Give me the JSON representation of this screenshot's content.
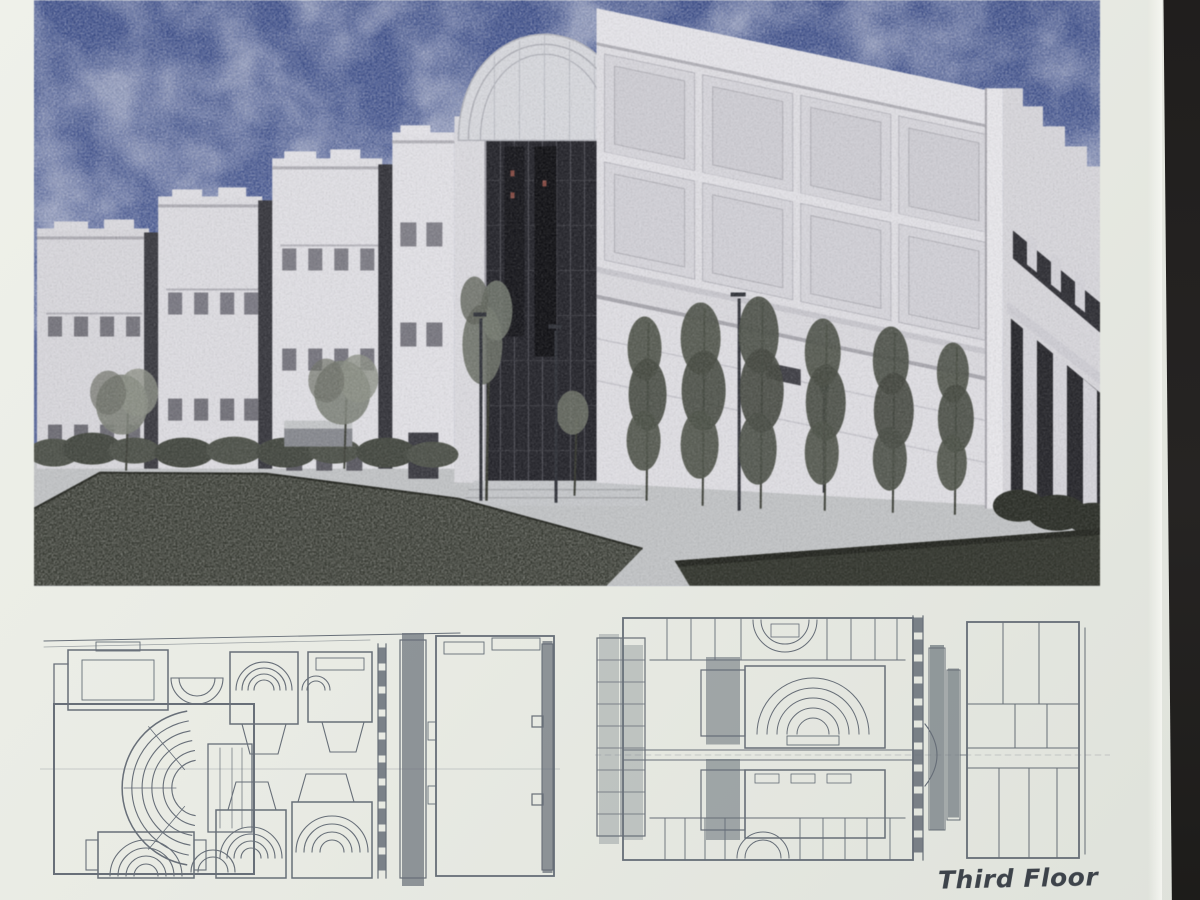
{
  "page": {
    "caption": "Third Floor",
    "paper_color": "#eaece5",
    "backdrop_color": "#211f1e"
  },
  "photo": {
    "description": "Color architectural rendering of a three-storey academic building with a barrel-vaulted glass atrium, coffered concrete block, right-hand colonnade, rows of young trees, walkways and a dark planted mound in the foreground",
    "sky_color": "#47598f",
    "facade_color": "#dddce1",
    "glazing_color": "#23232a",
    "lawn_color": "#393c33"
  },
  "plans": {
    "line_color": "#4d5663",
    "left_plan_description": "Floor plan with large fan-shaped auditorium, four lecture theatres with curved seating, stair lobbies, service spine and east room",
    "right_plan_description": "Third floor plan with central lecture theatre, perimeter rooms, stair shafts, circulation spine and east wing",
    "caption_label": "Third Floor"
  }
}
